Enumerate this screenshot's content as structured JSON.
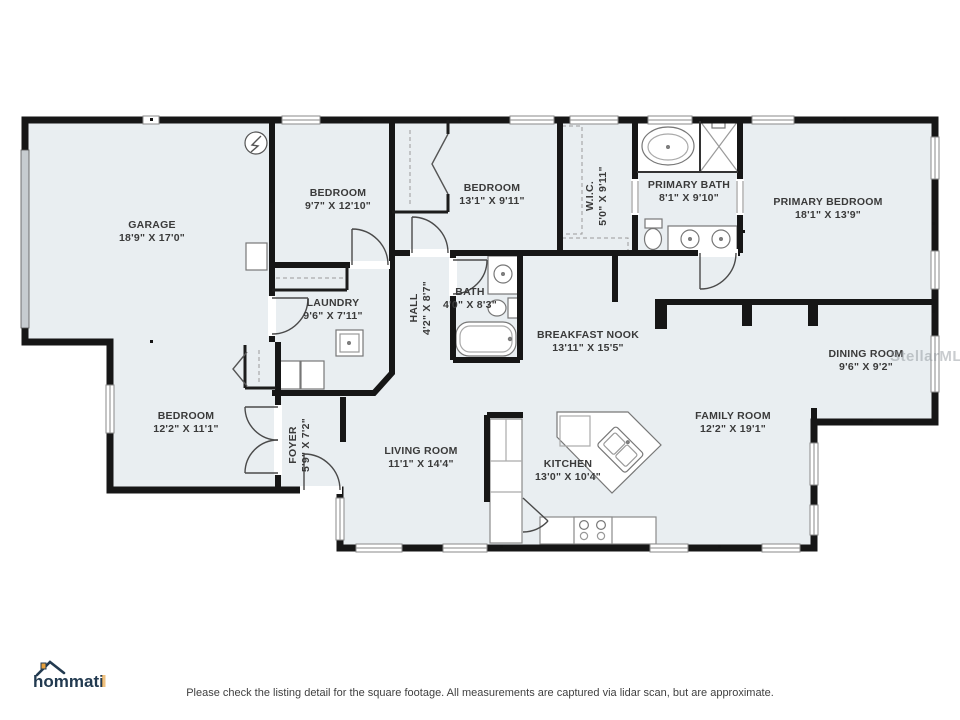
{
  "plan": {
    "rooms": {
      "garage": {
        "name": "GARAGE",
        "dims": "18'9\" X 17'0\""
      },
      "bedroom2": {
        "name": "BEDROOM",
        "dims": "9'7\" X 12'10\""
      },
      "bedroom3": {
        "name": "BEDROOM",
        "dims": "13'1\" X 9'11\""
      },
      "wic": {
        "name": "W.I.C.",
        "dims": "5'0\" X 9'11\""
      },
      "primary_bath": {
        "name": "PRIMARY BATH",
        "dims": "8'1\" X 9'10\""
      },
      "primary_bedroom": {
        "name": "PRIMARY BEDROOM",
        "dims": "18'1\" X 13'9\""
      },
      "laundry": {
        "name": "LAUNDRY",
        "dims": "9'6\" X 7'11\""
      },
      "hall": {
        "name": "HALL",
        "dims": "4'2\" X 8'7\""
      },
      "bath": {
        "name": "BATH",
        "dims": "4'0\" X 8'3\""
      },
      "breakfast_nook": {
        "name": "BREAKFAST NOOK",
        "dims": "13'11\" X 15'5\""
      },
      "dining": {
        "name": "DINING ROOM",
        "dims": "9'6\" X 9'2\""
      },
      "bedroom4": {
        "name": "BEDROOM",
        "dims": "12'2\" X 11'1\""
      },
      "foyer": {
        "name": "FOYER",
        "dims": "5'9\" X 7'2\""
      },
      "living": {
        "name": "LIVING ROOM",
        "dims": "11'1\" X 14'4\""
      },
      "kitchen": {
        "name": "KITCHEN",
        "dims": "13'0\" X 10'4\""
      },
      "family": {
        "name": "FAMILY ROOM",
        "dims": "12'2\" X 19'1\""
      }
    },
    "watermark": "StellarMLS"
  },
  "logo": {
    "text": "hommati"
  },
  "footer": {
    "disclaimer": "Please check the listing detail for the square footage. All measurements are captured via lidar scan, but are approximate."
  },
  "colors": {
    "wall": "#161616",
    "room_fill": "#e9eef1",
    "fixture_stroke": "#777777",
    "label_text": "#3a3a3a",
    "logo_navy": "#223a50",
    "logo_orange": "#e7a03c"
  }
}
